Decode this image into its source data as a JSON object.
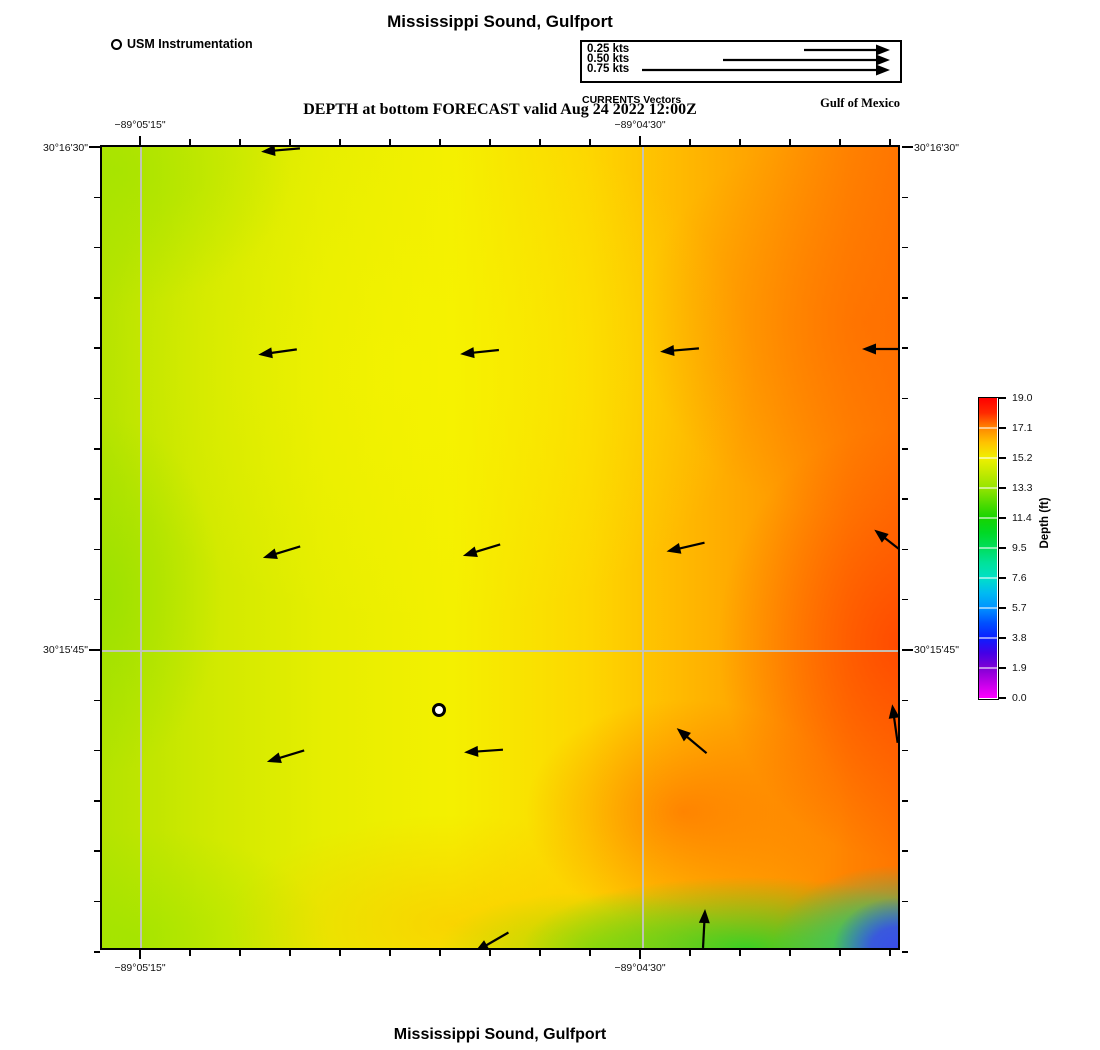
{
  "titles": {
    "top": "Mississippi Sound, Gulfport",
    "subtitle": "DEPTH at bottom FORECAST valid Aug 24 2022 12:00Z",
    "bottom": "Mississippi Sound, Gulfport"
  },
  "legend": {
    "usm_label": "USM Instrumentation"
  },
  "region_label": "Gulf of Mexico",
  "vector_legend": {
    "caption": "CURRENTS Vectors",
    "items": [
      {
        "label": "0.25 kts",
        "length_px": 87
      },
      {
        "label": "0.50 kts",
        "length_px": 168
      },
      {
        "label": "0.75 kts",
        "length_px": 249
      }
    ]
  },
  "axes": {
    "x_labels": [
      "−89°05'15\"",
      "−89°04'30\""
    ],
    "y_labels": [
      "30°16'30\"",
      "30°15'45\""
    ]
  },
  "colorbar": {
    "label": "Depth (ft)",
    "ticks": [
      "19.0",
      "17.1",
      "15.2",
      "13.3",
      "11.4",
      "9.5",
      "7.6",
      "5.7",
      "3.8",
      "1.9",
      "0.0"
    ],
    "top_color": "#ff0000",
    "bottom_color": "#ff00ff"
  },
  "chart_data": {
    "type": "heatmap",
    "title": "Mississippi Sound, Gulfport",
    "subtitle": "DEPTH at bottom FORECAST valid Aug 24 2022 12:00Z",
    "valid_time": "Aug 24 2022 12:00Z",
    "variable": "Depth (ft)",
    "colorbar_range": [
      0.0,
      19.0
    ],
    "colorbar_ticks": [
      19.0,
      17.1,
      15.2,
      13.3,
      11.4,
      9.5,
      7.6,
      5.7,
      3.8,
      1.9,
      0.0
    ],
    "x_axis": {
      "tick_labels": [
        "−89°05'15\"",
        "−89°04'30\""
      ],
      "gridline_px": [
        40,
        540
      ]
    },
    "y_axis": {
      "tick_labels": [
        "30°16'30\"",
        "30°15'45\""
      ],
      "gridline_px": [
        0,
        505
      ]
    },
    "field_summary": "Depth ~13–15 ft (yellow-green) in the west grading to ~17–19 ft (orange-red) in the east; a shallow ~9–11 ft green band along the southeast bottom edge drops to ~2–5 ft (blue) at the extreme SE corner",
    "instrument_marker_px": {
      "x": 337,
      "y": 563
    },
    "vector_speeds_kts_legend": [
      0.25,
      0.5,
      0.75
    ],
    "angle_convention": "0 = pointing right/east, degrees clockwise on screen",
    "vectors_px": [
      {
        "x": 179,
        "y": 3,
        "angle": 175
      },
      {
        "x": 176,
        "y": 205,
        "angle": 172
      },
      {
        "x": 378,
        "y": 205,
        "angle": 174
      },
      {
        "x": 578,
        "y": 203,
        "angle": 175
      },
      {
        "x": 780,
        "y": 202,
        "angle": 180
      },
      {
        "x": 180,
        "y": 405,
        "angle": 163
      },
      {
        "x": 380,
        "y": 403,
        "angle": 163
      },
      {
        "x": 584,
        "y": 400,
        "angle": 167
      },
      {
        "x": 788,
        "y": 395,
        "angle": 218
      },
      {
        "x": 184,
        "y": 609,
        "angle": 163
      },
      {
        "x": 382,
        "y": 604,
        "angle": 176
      },
      {
        "x": 590,
        "y": 594,
        "angle": 220
      },
      {
        "x": 793,
        "y": 577,
        "angle": 262
      },
      {
        "x": 390,
        "y": 795,
        "angle": 150
      },
      {
        "x": 602,
        "y": 782,
        "angle": 273
      }
    ],
    "layout": {
      "map": {
        "left": 100,
        "top": 145,
        "width": 800,
        "height": 805
      },
      "xticks": {
        "start": 38,
        "step": 50.0,
        "count": 16,
        "label_idx": [
          0,
          10
        ]
      },
      "yticks": {
        "start": 0,
        "step": 50.3,
        "count": 17,
        "label_idx": [
          0,
          10
        ]
      },
      "cbar_step_px": 30.0
    }
  }
}
